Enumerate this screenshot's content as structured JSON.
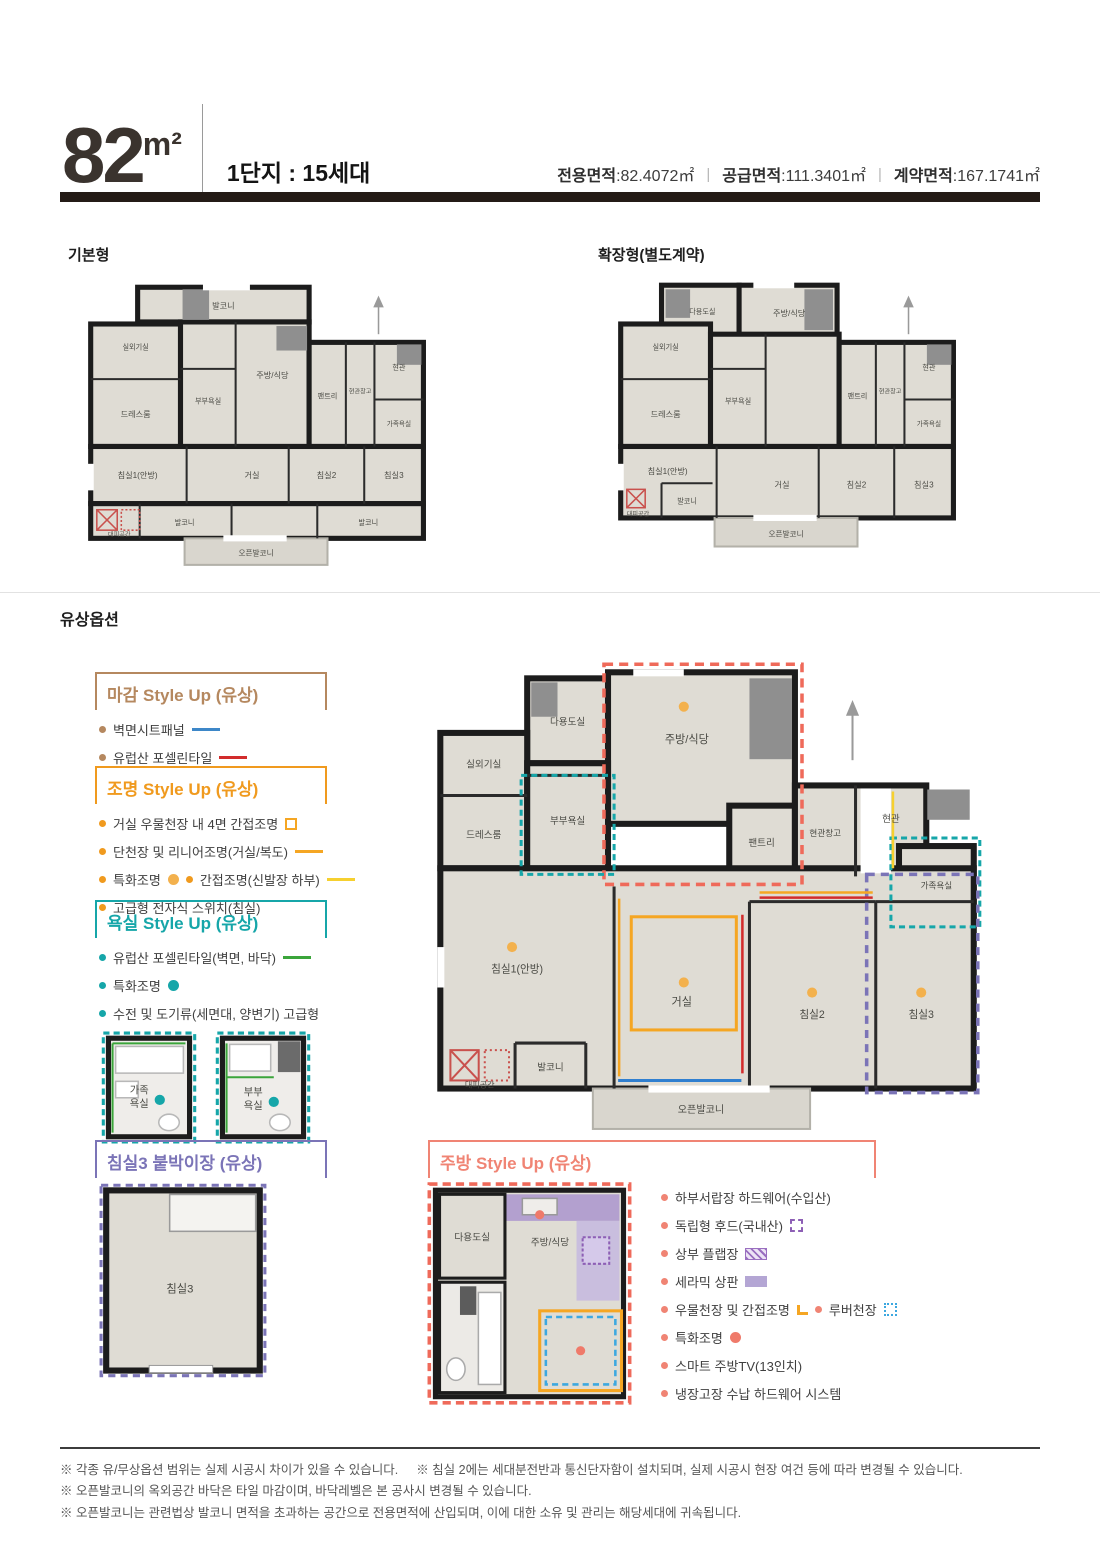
{
  "palette": {
    "bar_dark": "#241b16",
    "tan": "#b5885f",
    "orange": "#f09a1e",
    "teal": "#16a6a9",
    "purple": "#7b74b7",
    "salmon": "#f08474",
    "swatch_blue": "#3d87c8",
    "swatch_red": "#d22c2c",
    "swatch_green": "#3ba53b",
    "swatch_yellow": "#f6d02f",
    "swatch_lavender": "#b4a6d4"
  },
  "header": {
    "size": "82",
    "unit": "m²",
    "complex": "1단지 : 15세대",
    "areas": [
      {
        "label": "전용면적",
        "value": "82.4072㎡"
      },
      {
        "label": "공급면적",
        "value": "111.3401㎡"
      },
      {
        "label": "계약면적",
        "value": "167.1741㎡"
      }
    ]
  },
  "plans": {
    "basic": {
      "title": "기본형",
      "rooms": [
        "발코니",
        "실외기실",
        "드레스룸",
        "부부욕실",
        "주방/식당",
        "팬트리",
        "현관창고",
        "현관",
        "가족욕실",
        "침실1(안방)",
        "거실",
        "침실2",
        "침실3",
        "발코니",
        "발코니",
        "대피공간",
        "오픈발코니"
      ]
    },
    "extended": {
      "title": "확장형(별도계약)",
      "rooms": [
        "다용도실",
        "실외기실",
        "드레스룸",
        "부부욕실",
        "주방/식당",
        "팬트리",
        "현관창고",
        "현관",
        "가족욕실",
        "침실1(안방)",
        "거실",
        "침실2",
        "침실3",
        "발코니",
        "대피공간",
        "오픈발코니"
      ]
    },
    "option_main": {
      "rooms": [
        "다용도실",
        "실외기실",
        "드레스룸",
        "부부욕실",
        "주방/식당",
        "팬트리",
        "현관창고",
        "현관",
        "가족욕실",
        "침실1(안방)",
        "거실",
        "침실2",
        "침실3",
        "발코니",
        "대피공간",
        "오픈발코니"
      ]
    },
    "kitchen": {
      "rooms": [
        "다용도실",
        "주방/식당"
      ]
    },
    "bathrooms": {
      "family": {
        "l1": "가족",
        "l2": "욕실"
      },
      "master": {
        "l1": "부부",
        "l2": "욕실"
      }
    },
    "bedroom3": {
      "label": "침실3"
    }
  },
  "options": {
    "section_title": "유상옵션",
    "finish": {
      "title": "마감 Style Up (유상)",
      "items": [
        "벽면시트패널",
        "유럽산 포셀린타일"
      ]
    },
    "lighting": {
      "title": "조명 Style Up (유상)",
      "items": [
        "거실 우물천장 내 4면 간접조명",
        "단천장 및 리니어조명(거실/복도)",
        "특화조명",
        "간접조명(신발장 하부)",
        "고급형 전자식 스위치(침실)"
      ]
    },
    "bath": {
      "title": "욕실 Style Up (유상)",
      "items": [
        "유럽산 포셀린타일(벽면, 바닥)",
        "특화조명",
        "수전 및 도기류(세면대, 양변기) 고급형"
      ]
    },
    "bedroom3": {
      "title": "침실3 붙박이장 (유상)"
    },
    "kitchen": {
      "title": "주방 Style Up (유상)",
      "items": [
        "하부서랍장 하드웨어(수입산)",
        "독립형 후드(국내산)",
        "상부 플랩장",
        "세라믹 상판",
        "우물천장 및 간접조명",
        "루버천장",
        "특화조명",
        "스마트 주방TV(13인치)",
        "냉장고장 수납 하드웨어 시스템"
      ]
    }
  },
  "notes": [
    "※ 각종 유/무상옵션 범위는 실제 시공시 차이가 있을 수 있습니다.",
    "※ 침실 2에는 세대분전반과 통신단자함이 설치되며, 실제 시공시 현장 여건 등에 따라 변경될 수 있습니다.",
    "※ 오픈발코니의 옥외공간 바닥은 타일 마감이며, 바닥레벨은 본 공사시 변경될 수 있습니다.",
    "※ 오픈발코니는 관련법상 발코니 면적을 초과하는 공간으로 전용면적에 산입되며, 이에 대한 소유 및 관리는 해당세대에 귀속됩니다."
  ]
}
